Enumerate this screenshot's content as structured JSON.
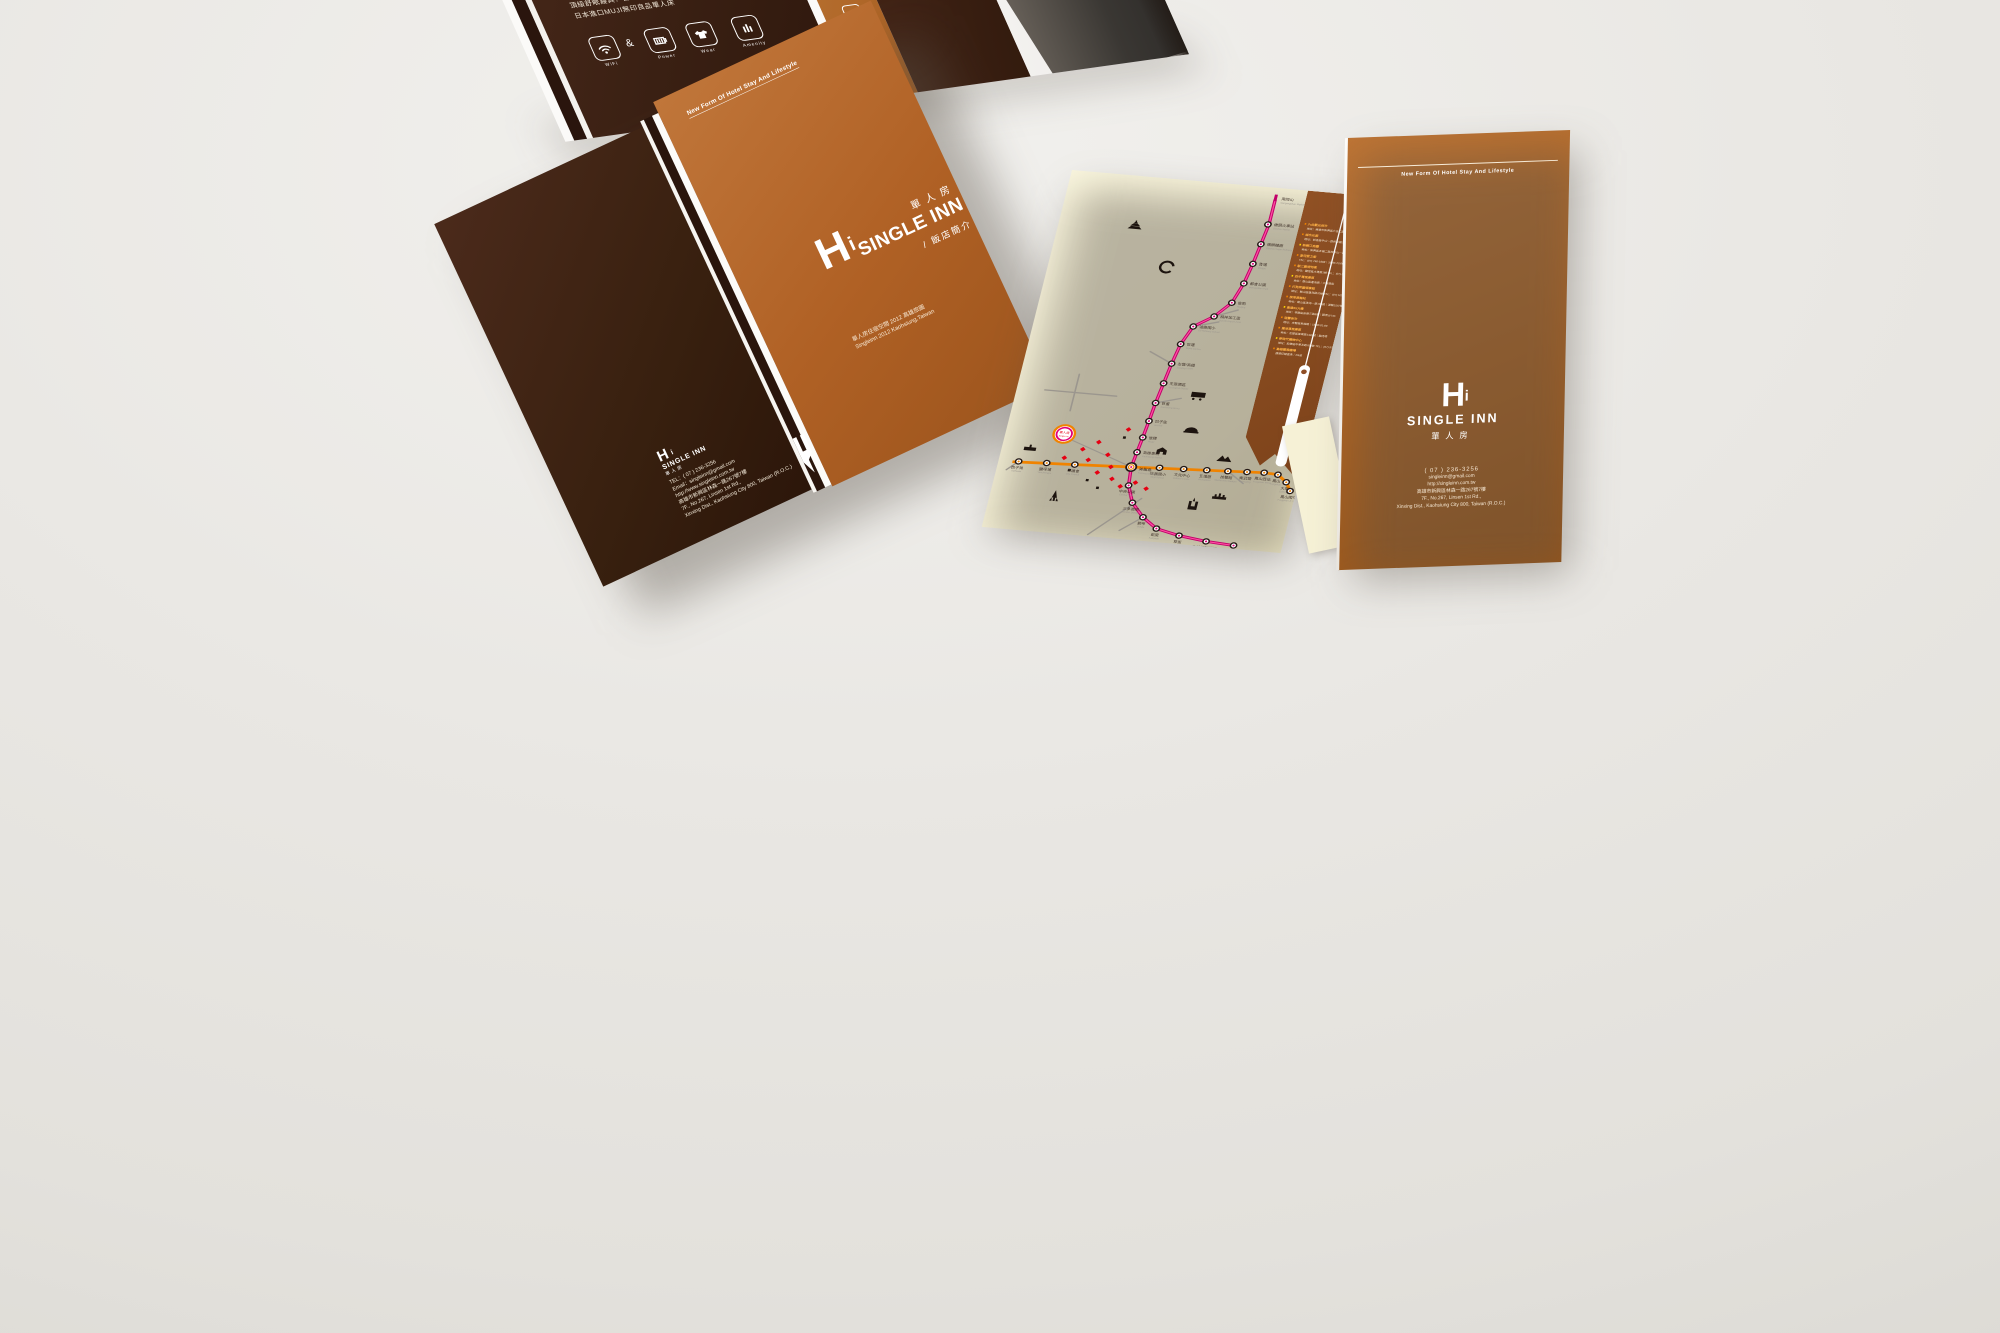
{
  "colors": {
    "background": "#e9e7e3",
    "dark_brown": "#38200f",
    "caramel": "#b06125",
    "cream": "#f7f2d8",
    "map_red_line": "#e0007a",
    "map_orange_line": "#f08300",
    "flap_brown": "#8f4e26",
    "accent_yellow": "#ffd800"
  },
  "brand": {
    "name_en": "SINGLE INN",
    "name_zh": "單人房",
    "subtitle_zh": "/ 飯店簡介",
    "tagline": "New Form Of Hotel Stay And Lifestyle",
    "h_glyph": "H",
    "i_glyph": "i"
  },
  "top_brochure": {
    "feature_lines": [
      "奢華視聽設備：USB充電插座",
      "Philips立體電視機",
      "頂級舒眠寢具：台灣製天然羽絨棉被",
      "日本進口MUJI無印良品單人床"
    ],
    "icon_row": {
      "separator": "&",
      "items": [
        {
          "icon": "wifi-icon",
          "label": "WiFi"
        },
        {
          "icon": "power-icon",
          "label": "Power"
        },
        {
          "icon": "wear-icon",
          "label": "Wear"
        },
        {
          "icon": "amenity-icon",
          "label": "Amenity"
        }
      ]
    },
    "amenity_column_icons": [
      "toiletries-icon",
      "bottle-icon",
      "coffee-icon",
      "laundry-icon",
      "bus-icon",
      "taxi-icon",
      "concierge-icon",
      "luggage-icon",
      "ferry-icon"
    ],
    "english_lines": [
      "and lif",
      "watch TV fr",
      "body and min",
      "you can also excha",
      "restaurant."
    ]
  },
  "left_brochure": {
    "front": {
      "caption_zh": "單人房住宿空間 2012 高雄旅圖",
      "caption_en": "Singleinn 2012 Kaohsiung,Taiwan"
    },
    "back": {
      "tel": "TEL：( 07 ) 236-3256",
      "email": "Email：singleinn@gmail.com",
      "web": "http://www.singleinn.com.tw",
      "addr_zh": "高雄市新興區林森一路267號7樓",
      "addr_en1": "7F., No.267, Linsen 1st Rd.,",
      "addr_en2": "Xinxing Dist., Kaohsiung City 800, Taiwan (R.O.C.)"
    }
  },
  "right_brochure": {
    "contact_lines": [
      "( 07 ) 236-3256",
      "singleinn@gmail.com",
      "http://singleinn.com.tw",
      "高雄市新興區林森一路267號7樓",
      "7F., No.267, Linsen 1st Rd.,",
      "Xinxing Dist., Kaohsiung City 800, Taiwan (R.O.C.)"
    ]
  },
  "map_brochure": {
    "terminus": {
      "zh": "南岡山",
      "en": "Nangangshan Station",
      "x": 207,
      "y": 12
    },
    "red_line": {
      "color": "#e0007a",
      "path": [
        [
          207,
          14
        ],
        [
          207,
          44
        ],
        [
          204,
          68
        ],
        [
          201,
          92
        ],
        [
          197,
          116
        ],
        [
          190,
          140
        ],
        [
          176,
          158
        ],
        [
          158,
          172
        ],
        [
          150,
          194
        ],
        [
          146,
          218
        ],
        [
          143,
          242
        ],
        [
          140,
          266
        ],
        [
          138,
          288
        ],
        [
          136,
          308
        ],
        [
          134,
          326
        ],
        [
          132,
          344
        ],
        [
          134,
          366
        ],
        [
          142,
          386
        ],
        [
          156,
          402
        ],
        [
          172,
          414
        ],
        [
          196,
          420
        ],
        [
          224,
          424
        ],
        [
          252,
          426
        ]
      ],
      "stations": [
        {
          "zh": "橋頭火車站",
          "en": "Qiaotou Station",
          "x": 206,
          "y": 44
        },
        {
          "zh": "橋頭糖廠",
          "en": "Qiaotou Sugar Refinery",
          "x": 204,
          "y": 68
        },
        {
          "zh": "青埔",
          "en": "Qingpu",
          "x": 201,
          "y": 92
        },
        {
          "zh": "都會公園",
          "en": "Metropolitan Park",
          "x": 197,
          "y": 116
        },
        {
          "zh": "後勁",
          "en": "Houjing",
          "x": 190,
          "y": 140
        },
        {
          "zh": "楠梓加工區",
          "en": "Nanzih Export Zone",
          "x": 176,
          "y": 158
        },
        {
          "zh": "油廠國小",
          "en": "Oil Refinery School",
          "x": 158,
          "y": 172
        },
        {
          "zh": "世運",
          "en": "World Games",
          "x": 150,
          "y": 194
        },
        {
          "zh": "左營/高鐵",
          "en": "Zuoying / HSR",
          "x": 146,
          "y": 218
        },
        {
          "zh": "生態園區",
          "en": "Ecological District",
          "x": 143,
          "y": 242
        },
        {
          "zh": "巨蛋",
          "en": "Kaohsiung Arena",
          "x": 140,
          "y": 266
        },
        {
          "zh": "凹子底",
          "en": "Aozihdi",
          "x": 138,
          "y": 288
        },
        {
          "zh": "後驛",
          "en": "Houyi",
          "x": 136,
          "y": 308
        },
        {
          "zh": "高雄車站",
          "en": "Kaohsiung Station",
          "x": 134,
          "y": 326
        },
        {
          "zh": "中央公園",
          "en": "Central Park",
          "x": 134,
          "y": 366
        },
        {
          "zh": "三多商圈",
          "en": "Sanduo District",
          "x": 142,
          "y": 386
        },
        {
          "zh": "獅甲",
          "en": "Shihjia",
          "x": 156,
          "y": 402
        },
        {
          "zh": "凱旋",
          "en": "Kaisyuan",
          "x": 172,
          "y": 414
        },
        {
          "zh": "草衙",
          "en": "Caoya",
          "x": 196,
          "y": 420
        },
        {
          "zh": "高雄國際機場",
          "en": "Kaohsiung Intl Airport",
          "x": 224,
          "y": 424
        },
        {
          "zh": "小港",
          "en": "Siaogang",
          "x": 252,
          "y": 426
        }
      ]
    },
    "orange_line": {
      "color": "#f08300",
      "path": [
        [
          14,
          350
        ],
        [
          76,
          347
        ],
        [
          132,
          344
        ],
        [
          228,
          339
        ],
        [
          264,
          337
        ],
        [
          278,
          338
        ],
        [
          288,
          346
        ],
        [
          294,
          356
        ]
      ],
      "stations": [
        {
          "zh": "西子灣",
          "en": "Sizihwan",
          "x": 20,
          "y": 349
        },
        {
          "zh": "鹽埕埔",
          "en": "Yanchengpu",
          "x": 48,
          "y": 348
        },
        {
          "zh": "市議會",
          "en": "City Council",
          "x": 76,
          "y": 347
        },
        {
          "zh": "信義國小",
          "en": "Sinyi School",
          "x": 160,
          "y": 342
        },
        {
          "zh": "文化中心",
          "en": "Cultural Center",
          "x": 184,
          "y": 341
        },
        {
          "zh": "五塊厝",
          "en": "Wukuaicuo",
          "x": 207,
          "y": 340
        },
        {
          "zh": "技擊館",
          "en": "Martial Arts Stadium",
          "x": 228,
          "y": 339
        },
        {
          "zh": "衛武營",
          "en": "Weiwuying",
          "x": 247,
          "y": 338
        },
        {
          "zh": "鳳山西站",
          "en": "Fongshan West",
          "x": 264,
          "y": 337
        },
        {
          "zh": "鳳山",
          "en": "Fongshan",
          "x": 278,
          "y": 338
        },
        {
          "zh": "大東",
          "en": "Dadong",
          "x": 288,
          "y": 346
        },
        {
          "zh": "鳳山國中",
          "en": "Fongshan Jr. High",
          "x": 294,
          "y": 356
        }
      ]
    },
    "junction": {
      "zh": "美麗島",
      "en": "Formosa Boulevard",
      "x": 132,
      "y": 344
    },
    "hotel_marker": {
      "zh": "單人房",
      "en": "Single Inn",
      "x": 58,
      "y": 312,
      "ring_outer": "#f08300",
      "ring_inner": "#e0007a"
    },
    "pois": [
      [
        94,
        318
      ],
      [
        106,
        332
      ],
      [
        88,
        340
      ],
      [
        100,
        354
      ],
      [
        116,
        360
      ],
      [
        126,
        368
      ],
      [
        80,
        328
      ],
      [
        140,
        362
      ],
      [
        112,
        346
      ],
      [
        152,
        368
      ],
      [
        64,
        340
      ],
      [
        120,
        300
      ]
    ],
    "poi_squares": [
      [
        92,
        364
      ],
      [
        118,
        310
      ],
      [
        72,
        354
      ],
      [
        104,
        372
      ]
    ],
    "roads": [
      "M28,262 L100,262",
      "M58,240 L58,284",
      "M150,380 L106,428",
      "M176,158 L198,148",
      "M158,172 L182,164",
      "M146,218 L122,206",
      "M140,266 L164,258",
      "M156,402 L136,420",
      "M228,339 L246,352",
      "M20,349 L10,360"
    ],
    "landmarks": [
      {
        "icon": "temple-icon",
        "x": 76,
        "y": 62
      },
      {
        "icon": "stadium-icon",
        "x": 118,
        "y": 106
      },
      {
        "icon": "train-icon",
        "x": 180,
        "y": 252
      },
      {
        "icon": "dome-icon",
        "x": 182,
        "y": 294
      },
      {
        "icon": "station-icon",
        "x": 158,
        "y": 322
      },
      {
        "icon": "mountain-icon",
        "x": 222,
        "y": 324
      },
      {
        "icon": "tower85-icon",
        "x": 202,
        "y": 388
      },
      {
        "icon": "mall-icon",
        "x": 226,
        "y": 370
      },
      {
        "icon": "rocket-icon",
        "x": 64,
        "y": 392
      },
      {
        "icon": "pier-icon",
        "x": 28,
        "y": 332
      }
    ],
    "info_panel": {
      "entries": [
        {
          "name": "六合觀光夜市",
          "detail": "地址：高雄市新興區六合二路｜17:00-05:00"
        },
        {
          "name": "城市光廊",
          "detail": "地址：前金區中山一路與五福三路口"
        },
        {
          "name": "新崛江商圈",
          "detail": "地址：新興區五福二路與中山一路口"
        },
        {
          "name": "愛河愛之船",
          "detail": "TEL：(07) 746-1888｜16:00-23:00"
        },
        {
          "name": "駁二藝術特區",
          "detail": "地址：鹽埕區大勇路1號 TEL：(07) 521-4899"
        },
        {
          "name": "西子灣風景區",
          "detail": "地址：鼓山區蓮海路｜夕陽景點"
        },
        {
          "name": "打狗英國領事館",
          "detail": "地址：鼓山區蓮海路20號 TEL：(07) 525-0100"
        },
        {
          "name": "旗津渡輪站",
          "detail": "地址：鼓山區濱海一路109號｜渡輪15分鐘"
        },
        {
          "name": "高雄85大樓",
          "detail": "地址：苓雅區自強三路5號｜觀景台74F"
        },
        {
          "name": "瑞豐夜市",
          "detail": "地址：左營區裕誠路｜18:00-01:00"
        },
        {
          "name": "蓮池潭風景區",
          "detail": "地址：左營區翠華路1435號｜龍虎塔"
        },
        {
          "name": "夢時代購物中心",
          "detail": "地址：前鎮區中華五路789號 TEL：(07) 973-3888"
        },
        {
          "name": "高雄國際機場",
          "detail": "捷運紅線直達｜R4站"
        }
      ]
    }
  }
}
